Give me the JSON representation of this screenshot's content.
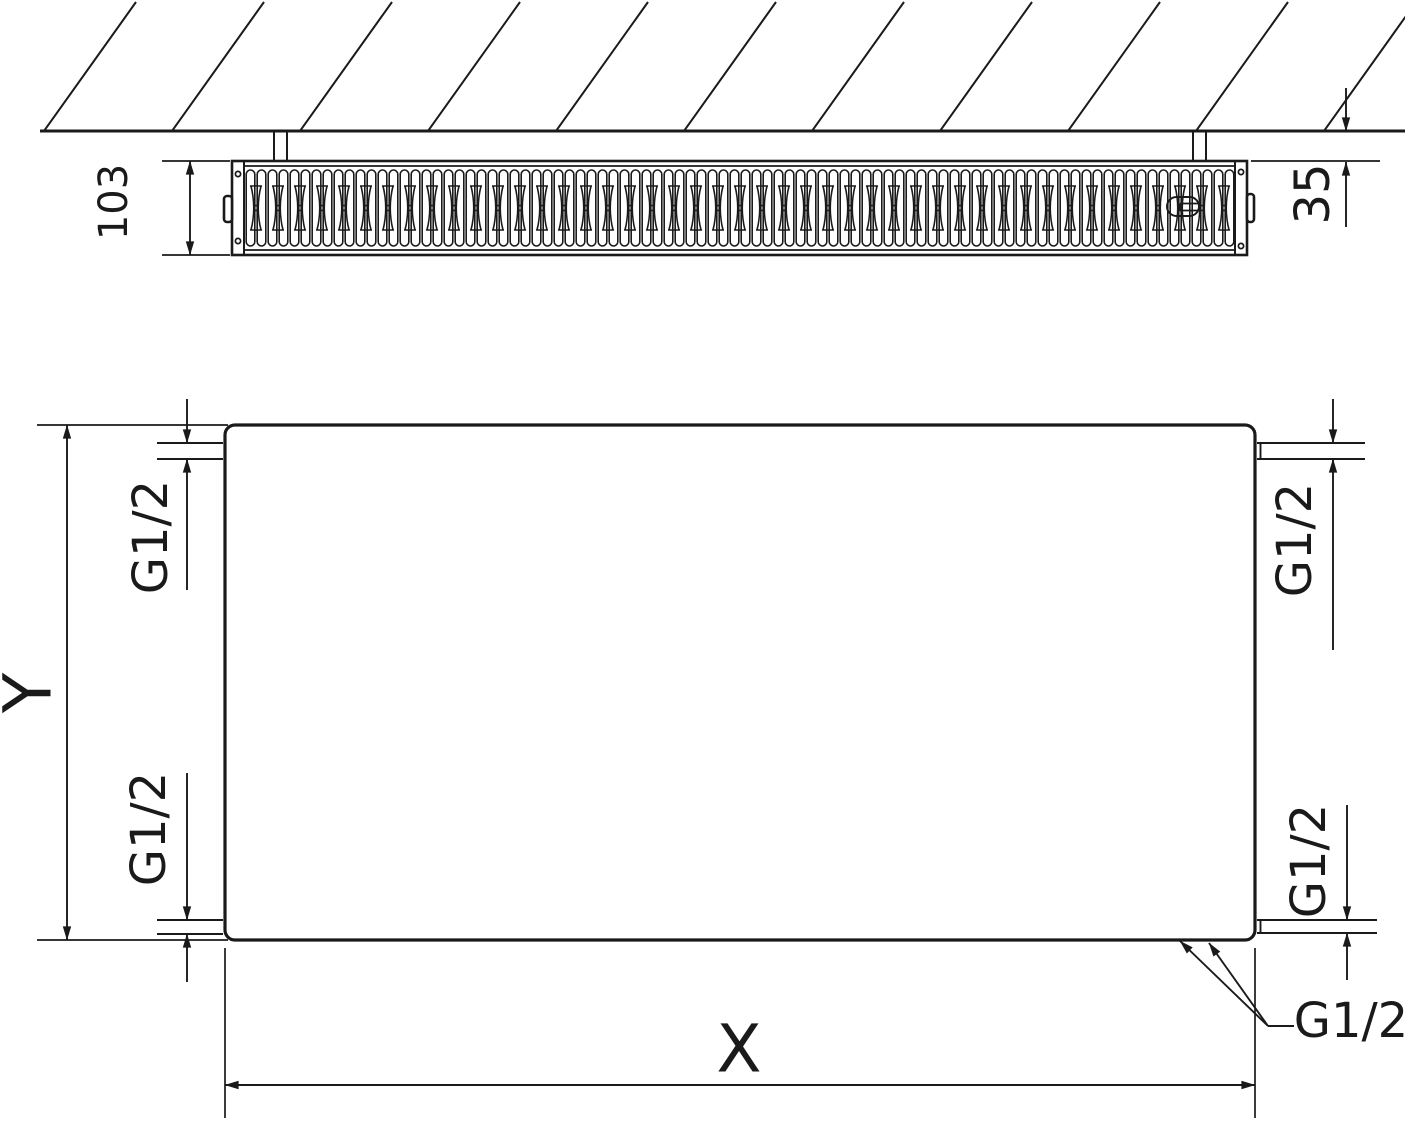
{
  "drawing": {
    "labels": {
      "depth": "103",
      "wall_distance": "35",
      "thread": "G1/2",
      "width": "X",
      "height": "Y"
    },
    "colors": {
      "line": "#1a1a1a",
      "background": "#ffffff"
    }
  }
}
